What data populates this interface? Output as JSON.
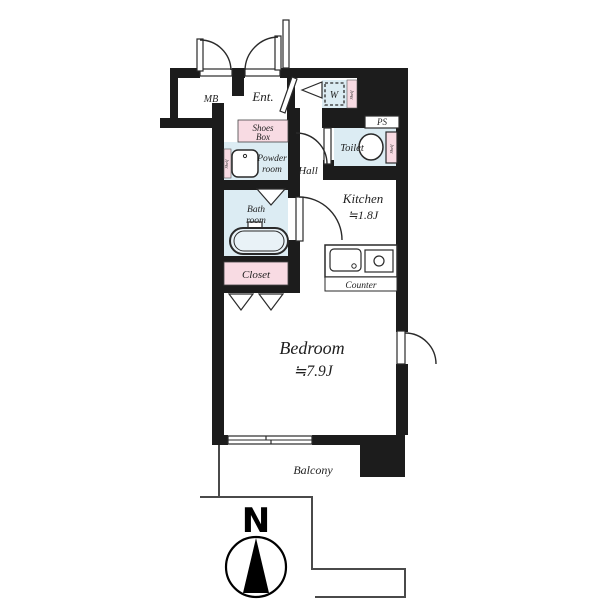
{
  "plan": {
    "type": "apartment-floor-plan",
    "compass": {
      "label": "N"
    },
    "labels": {
      "mb": "MB",
      "ent": "Ent.",
      "shoes_line1": "Shoes",
      "shoes_line2": "Box",
      "powder_line1": "Powder",
      "powder_line2": "room",
      "bath_line1": "Bath",
      "bath_line2": "room",
      "closet": "Closet",
      "hall": "Hall",
      "toilet": "Toilet",
      "washer": "W",
      "ps": "PS",
      "kitchen_name": "Kitchen",
      "kitchen_size": "≒1.8J",
      "counter": "Counter",
      "bedroom_name": "Bedroom",
      "bedroom_size": "≒7.9J",
      "balcony": "Balcony",
      "shelf": "Shelf"
    }
  },
  "colors": {
    "wall": "#1c1c1c",
    "wet_room": "#dcecf3",
    "storage_pink": "#f8dbe3",
    "tub_fill": "#e9f2f7",
    "outline": "#2a2a2a",
    "compass_arrow": "#000000"
  }
}
